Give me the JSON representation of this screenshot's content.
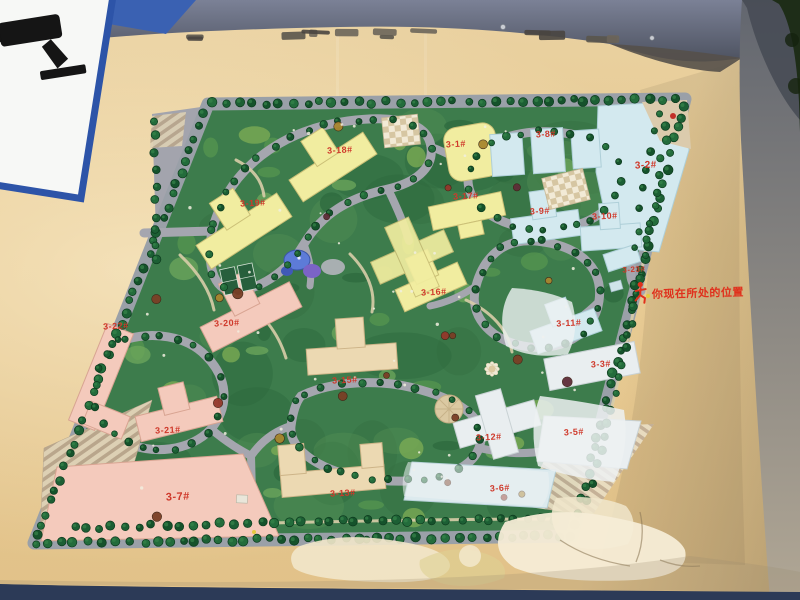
{
  "photo": {
    "board_color": "#e6c88f",
    "top_frame_color": "#5c6273",
    "right_frame_color": "#8e8e94",
    "bottom_strip_color": "#2c3a57",
    "foliage_color": "#1e2d18"
  },
  "cctv_sign": {
    "vertical_text": "系统联网",
    "border_color": "#2d54a8",
    "text_color": "#2b52a6"
  },
  "you_are_here": {
    "label": "你现在所处的位置",
    "color": "#e0301c"
  },
  "site_map": {
    "label_color": "#cf392b",
    "building_colors": {
      "yellow": "#f1eda0",
      "blue": "#d3e9ef",
      "pink": "#f4cabc",
      "tan": "#ecd9b2"
    },
    "buildings": [
      {
        "label": "3-1#",
        "x": 456,
        "y": 147,
        "type": "yellow"
      },
      {
        "label": "3-2#",
        "x": 646,
        "y": 168,
        "type": "blue",
        "size": 10
      },
      {
        "label": "3-3#",
        "x": 601,
        "y": 367,
        "type": "blue"
      },
      {
        "label": "3-5#",
        "x": 574,
        "y": 435,
        "type": "blue"
      },
      {
        "label": "3-6#",
        "x": 500,
        "y": 491,
        "type": "blue"
      },
      {
        "label": "3-7#",
        "x": 178,
        "y": 500,
        "type": "pink",
        "size": 11
      },
      {
        "label": "3-8#",
        "x": 546,
        "y": 137,
        "type": "blue"
      },
      {
        "label": "3-9#",
        "x": 540,
        "y": 214,
        "type": "blue"
      },
      {
        "label": "3-10#",
        "x": 605,
        "y": 219,
        "type": "blue"
      },
      {
        "label": "3-11#",
        "x": 569,
        "y": 326,
        "type": "blue"
      },
      {
        "label": "3-12#",
        "x": 489,
        "y": 440,
        "type": "blue"
      },
      {
        "label": "3-13#",
        "x": 343,
        "y": 496,
        "type": "tan"
      },
      {
        "label": "3-15#",
        "x": 345,
        "y": 383,
        "type": "tan"
      },
      {
        "label": "3-16#",
        "x": 434,
        "y": 295,
        "type": "yellow"
      },
      {
        "label": "3-17#",
        "x": 466,
        "y": 199,
        "type": "yellow"
      },
      {
        "label": "3-18#",
        "x": 340,
        "y": 153,
        "type": "yellow"
      },
      {
        "label": "3-19#",
        "x": 253,
        "y": 206,
        "type": "yellow"
      },
      {
        "label": "3-20#",
        "x": 227,
        "y": 326,
        "type": "pink"
      },
      {
        "label": "3-21#",
        "x": 168,
        "y": 433,
        "type": "pink"
      },
      {
        "label": "3-22#",
        "x": 116,
        "y": 329,
        "type": "pink"
      },
      {
        "label": "3-23#",
        "x": 634,
        "y": 272,
        "type": "blue",
        "size": 8
      }
    ]
  }
}
